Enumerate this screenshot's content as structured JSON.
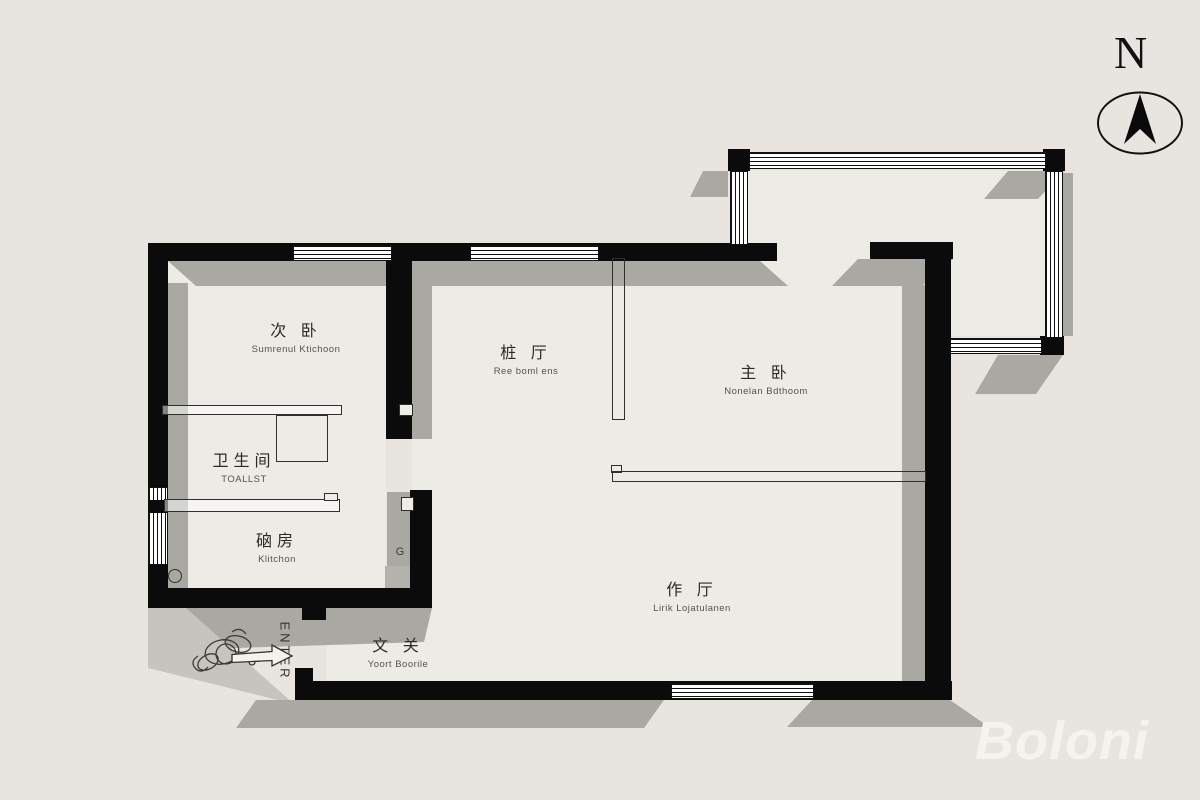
{
  "meta": {
    "title": "apartment floor plan",
    "style": "black-wall architectural plan with drop shadows"
  },
  "compass": {
    "label": "N"
  },
  "watermark": {
    "text": "Boloni"
  },
  "entrance": {
    "enter_label": "ENTER"
  },
  "annotations": {
    "g_label": "G"
  },
  "rooms": [
    {
      "id": "secondary-bedroom",
      "cn": "次 卧",
      "en": "Sumrenul Ktichoon"
    },
    {
      "id": "dining-room",
      "cn": "桩 厅",
      "en": "Ree boml ens"
    },
    {
      "id": "master-bedroom",
      "cn": "主 卧",
      "en": "Nonelan Bdthoom"
    },
    {
      "id": "toilet",
      "cn": "卫生间",
      "en": "TOALLST"
    },
    {
      "id": "kitchen",
      "cn": "硇房",
      "en": "Klitchon"
    },
    {
      "id": "living-room",
      "cn": "作 厅",
      "en": "Lirik Lojatulanen"
    },
    {
      "id": "entry-hall",
      "cn": "文 关",
      "en": "Yoort Boorile"
    }
  ],
  "colors": {
    "background": "#e8e5e0",
    "floor": "#edebe6",
    "wall": "#0b0b0b",
    "shadow": "#a9a8a3",
    "watermark": "#f4f3ee",
    "text": "#2b2a27"
  }
}
